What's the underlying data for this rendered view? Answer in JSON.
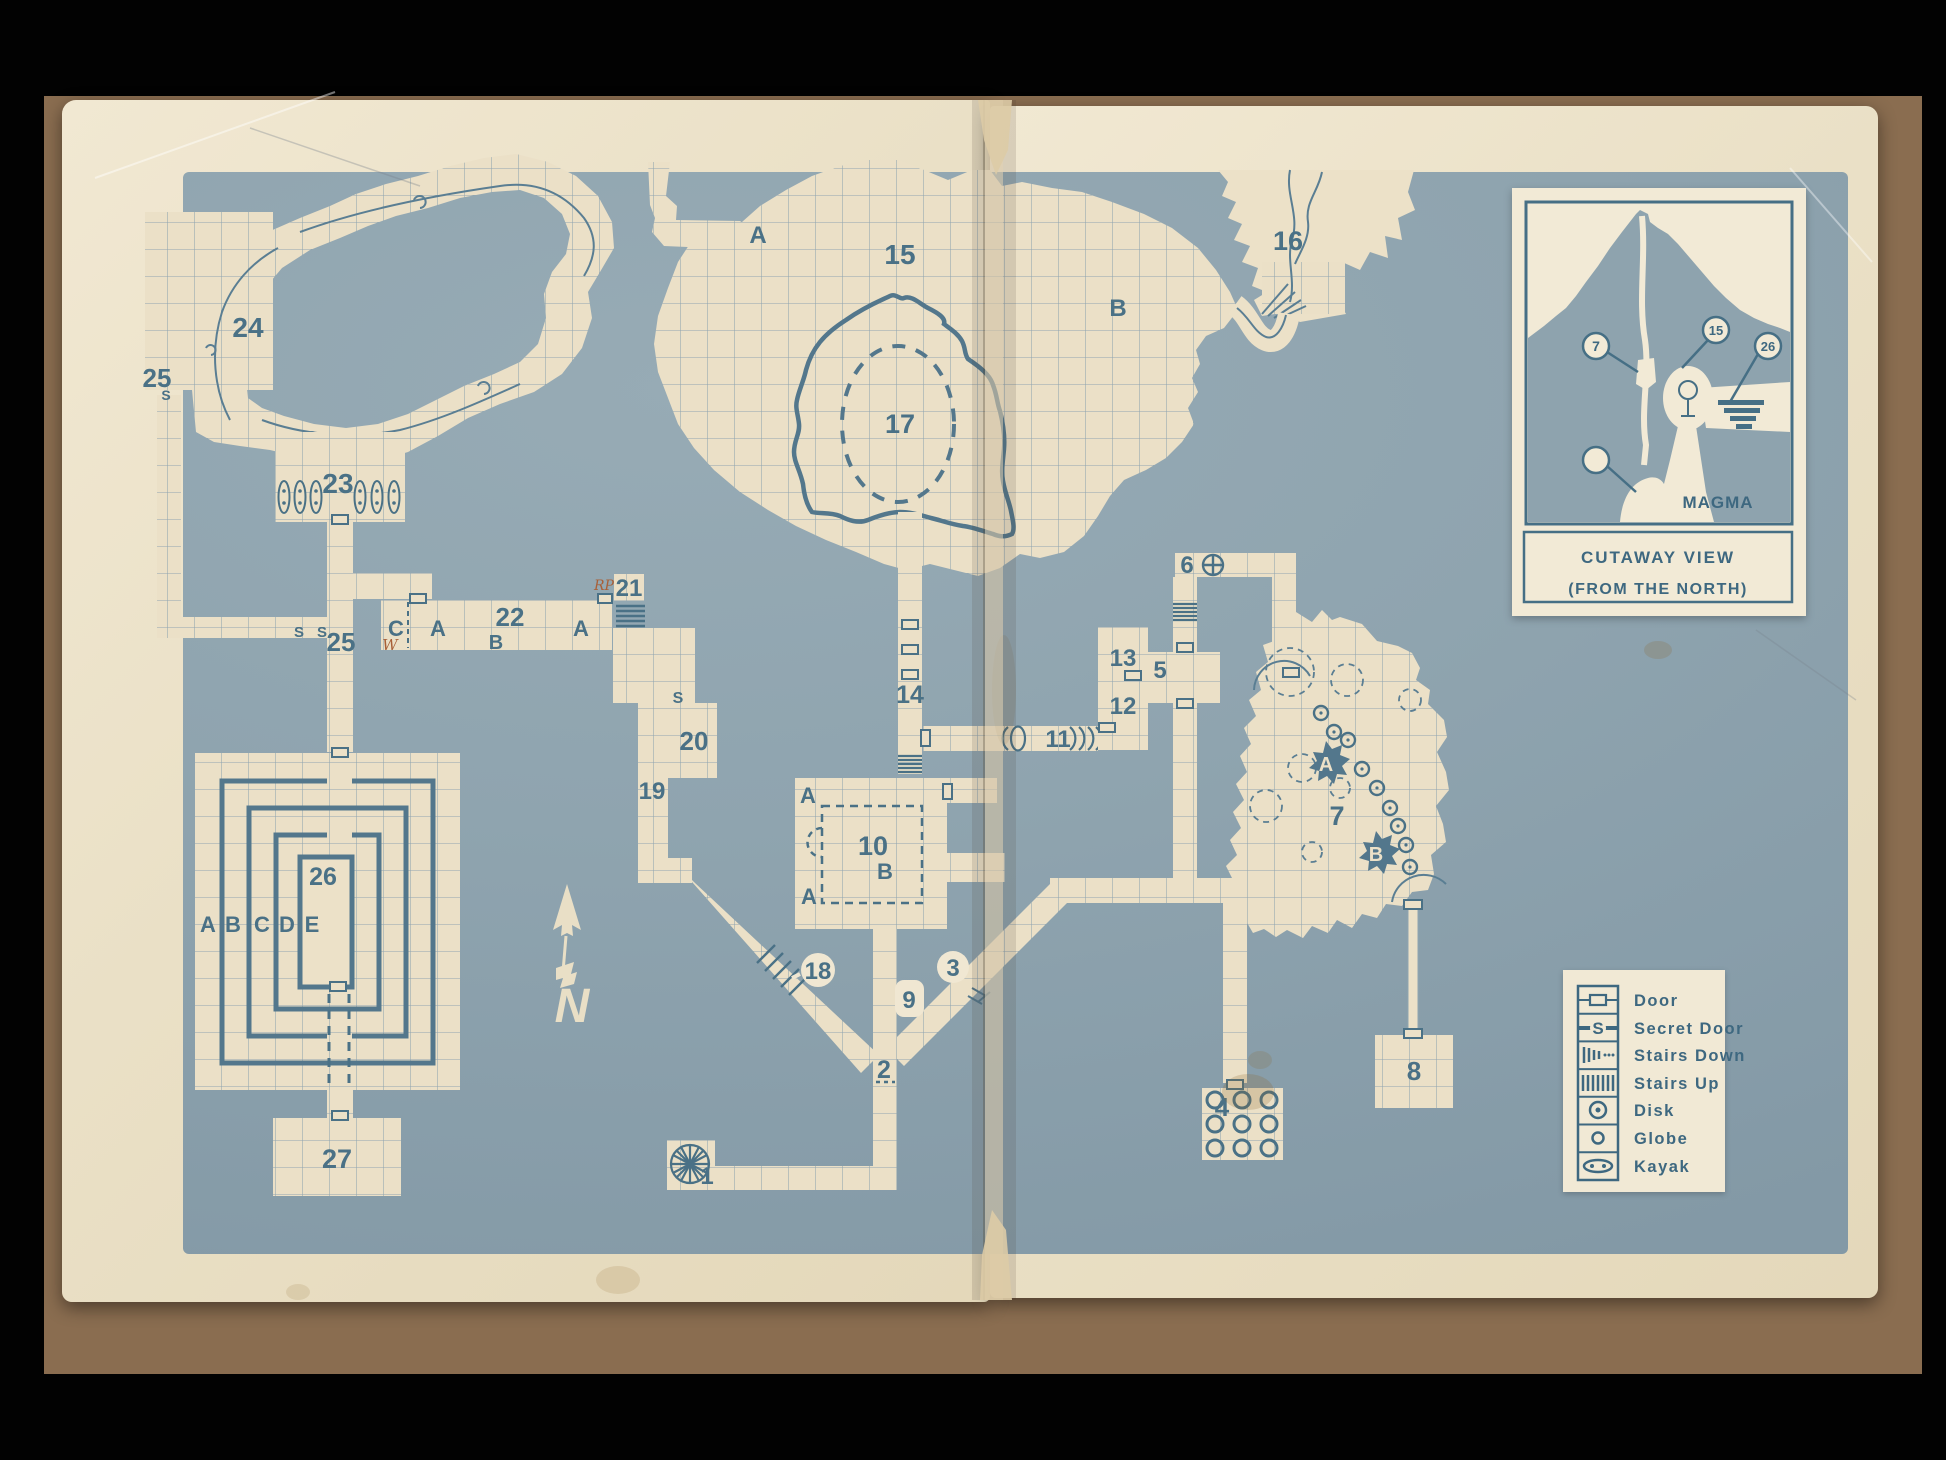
{
  "colors": {
    "paper": "#eae0c6",
    "blue_field": "#8fa4af",
    "ink_blue": "#4a7186",
    "backdrop_brown": "#8a6d50",
    "note_ink": "#a86038"
  },
  "map": {
    "rooms": {
      "r1": "1",
      "r2": "2",
      "r3": "3",
      "r4": "4",
      "r5": "5",
      "r6": "6",
      "r7": "7",
      "r8": "8",
      "r9": "9",
      "r10": "10",
      "r11": "11",
      "r12": "12",
      "r13": "13",
      "r14": "14",
      "r15": "15",
      "r16": "16",
      "r17": "17",
      "r18": "18",
      "r19": "19",
      "r20": "20",
      "r21": "21",
      "r22": "22",
      "r23": "23",
      "r24": "24",
      "r25_upper": "25",
      "r25_lower": "25",
      "r26": "26",
      "r27": "27"
    },
    "letters": {
      "cavern_a": "A",
      "cavern_b": "B",
      "room10_a_top": "A",
      "room10_b": "B",
      "room10_a_bottom": "A",
      "island_a": "A",
      "island_b": "B",
      "row_c": "C",
      "row_a1": "A",
      "row_b": "B",
      "row_a2": "A",
      "maze_a": "A",
      "maze_b": "B",
      "maze_c": "C",
      "maze_d": "D",
      "maze_e": "E"
    },
    "marks": {
      "secret_24": "S",
      "secret_corr_1": "S",
      "secret_corr_2": "S",
      "secret_20": "S",
      "north": "N",
      "note_rp": "RP",
      "note_w": "W"
    }
  },
  "legend": {
    "items": [
      {
        "icon": "door-icon",
        "label": "Door"
      },
      {
        "icon": "secret-door-icon",
        "label": "Secret Door"
      },
      {
        "icon": "stairs-down-icon",
        "label": "Stairs Down"
      },
      {
        "icon": "stairs-up-icon",
        "label": "Stairs Up"
      },
      {
        "icon": "disk-icon",
        "label": "Disk"
      },
      {
        "icon": "globe-icon",
        "label": "Globe"
      },
      {
        "icon": "kayak-icon",
        "label": "Kayak"
      }
    ]
  },
  "cutaway": {
    "callouts": {
      "c7": "7",
      "c15": "15",
      "c26": "26"
    },
    "magma": "MAGMA",
    "title": "CUTAWAY VIEW",
    "subtitle": "(FROM THE NORTH)"
  }
}
